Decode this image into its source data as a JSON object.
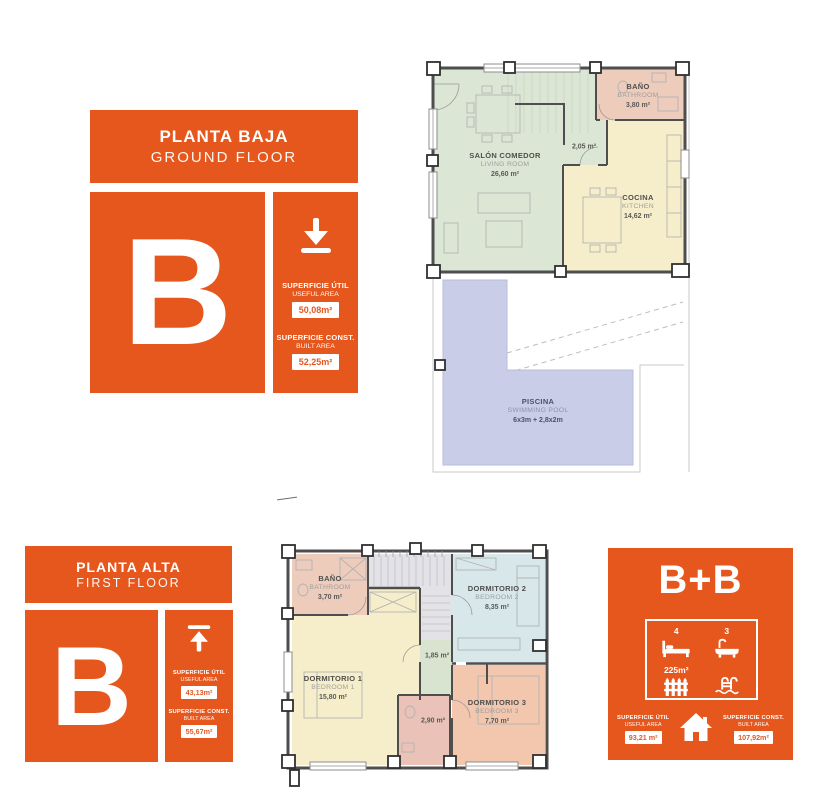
{
  "brand": {
    "accent_color": "#E6571E"
  },
  "ground_floor": {
    "header": {
      "title_es": "PLANTA BAJA",
      "title_en": "GROUND FLOOR"
    },
    "unit_letter": "B",
    "stats": {
      "level_icon": "arrow-down-icon",
      "useful_label_es": "SUPERFICIE ÚTIL",
      "useful_label_en": "USEFUL AREA",
      "useful_value": "50,08m²",
      "built_label_es": "SUPERFICIE CONST.",
      "built_label_en": "BUILT AREA",
      "built_value": "52,25m²"
    },
    "plan": {
      "living": {
        "name_es": "SALÓN COMEDOR",
        "name_en": "LIVING ROOM",
        "area": "26,60 m²"
      },
      "bathroom": {
        "name_es": "BAÑO",
        "name_en": "BATHROOM",
        "area": "3,80 m²"
      },
      "kitchen": {
        "name_es": "COCINA",
        "name_en": "KITCHEN",
        "area": "14,62 m²"
      },
      "hallway": {
        "area": "2,05 m²"
      },
      "pool": {
        "name_es": "PISCINA",
        "name_en": "SWIMMING POOL",
        "area": "6x3m + 2,8x2m"
      }
    }
  },
  "first_floor": {
    "header": {
      "title_es": "PLANTA ALTA",
      "title_en": "FIRST FLOOR"
    },
    "unit_letter": "B",
    "stats": {
      "level_icon": "arrow-up-icon",
      "useful_label_es": "SUPERFICIE ÚTIL",
      "useful_label_en": "USEFUL AREA",
      "useful_value": "43,13m²",
      "built_label_es": "SUPERFICIE CONST.",
      "built_label_en": "BUILT AREA",
      "built_value": "55,67m²"
    },
    "plan": {
      "bathroom": {
        "name_es": "BAÑO",
        "name_en": "BATHROOM",
        "area": "3,70 m²"
      },
      "bedroom2": {
        "name_es": "DORMITORIO 2",
        "name_en": "BEDROOM 2",
        "area": "8,35 m²"
      },
      "bedroom1": {
        "name_es": "DORMITORIO 1",
        "name_en": "BEDROOM 1",
        "area": "15,80 m²"
      },
      "hallway": {
        "area": "1,85 m²"
      },
      "bathroom2": {
        "area": "2,90 m²"
      },
      "bedroom3": {
        "name_es": "DORMITORIO 3",
        "name_en": "BEDROOM 3",
        "area": "7,70 m²"
      }
    }
  },
  "summary": {
    "title": "B+B",
    "bedrooms": {
      "count": "4",
      "icon": "bed-icon"
    },
    "bathrooms": {
      "count": "3",
      "icon": "bathtub-icon"
    },
    "plot": {
      "area": "225m²",
      "icon": "fence-icon"
    },
    "pool_icon": "pool-ladder-icon",
    "house_icon": "house-icon",
    "useful_label_es": "SUPERFICIE ÚTIL",
    "useful_label_en": "USEFUL AREA",
    "useful_value": "93,21 m²",
    "built_label_es": "SUPERFICIE CONST.",
    "built_label_en": "BUILT AREA",
    "built_value": "107,92m²"
  }
}
